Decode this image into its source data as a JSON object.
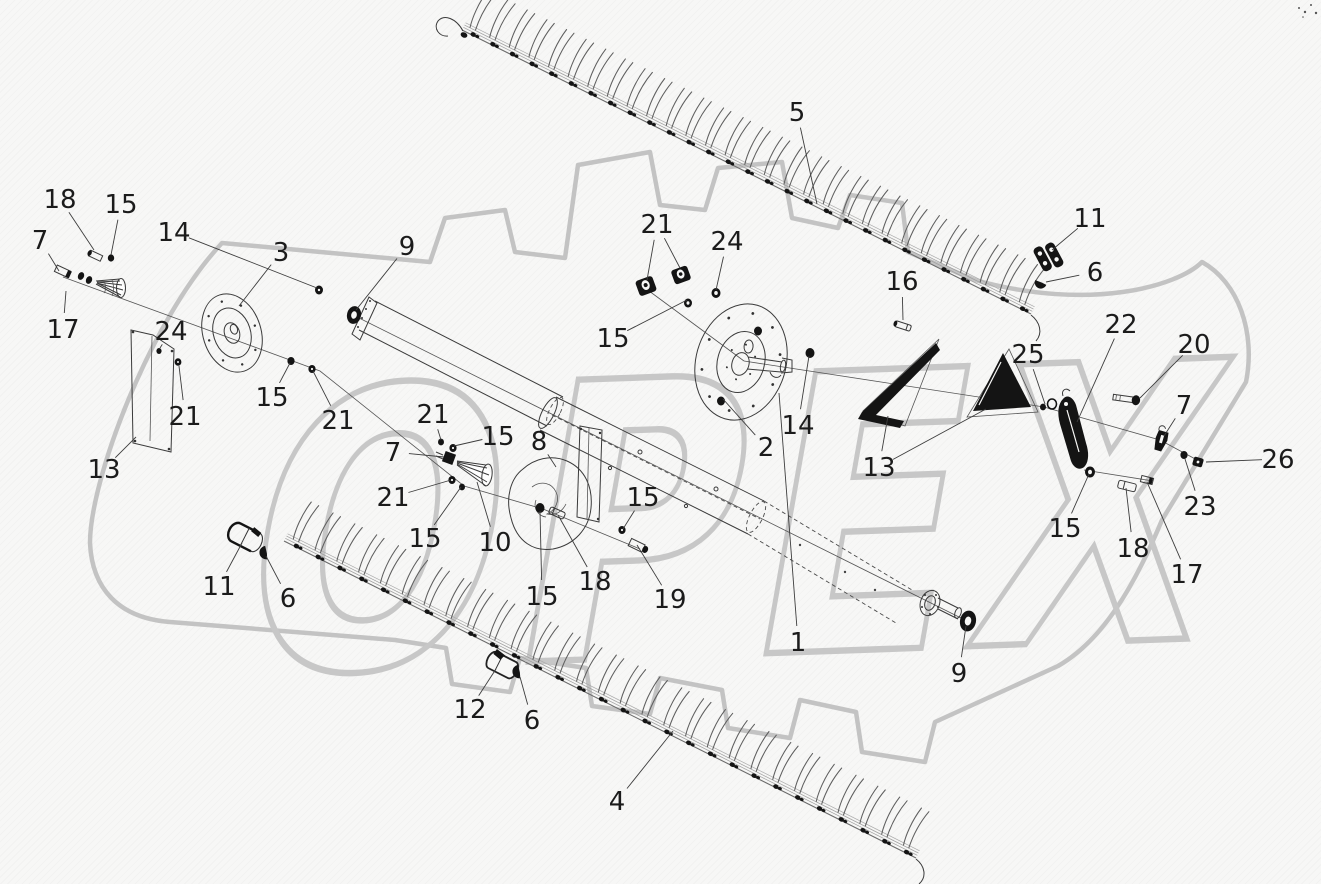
{
  "watermark": {
    "text": "OPEX",
    "color": "#c7c7c7"
  },
  "drawing": {
    "type": "exploded-parts-diagram",
    "background": "#f7f7f6",
    "line_color": "#3a3a3a",
    "part_fill_color": "#141414",
    "callout_color": "#1b1b1b"
  },
  "callouts": [
    {
      "label": "18",
      "x": 60,
      "y": 199,
      "targets": [
        [
          94,
          250
        ]
      ]
    },
    {
      "label": "15",
      "x": 121,
      "y": 204,
      "targets": [
        [
          111,
          255
        ]
      ]
    },
    {
      "label": "7",
      "x": 40,
      "y": 240,
      "targets": [
        [
          59,
          271
        ]
      ]
    },
    {
      "label": "17",
      "x": 63,
      "y": 329,
      "targets": [
        [
          66,
          291
        ]
      ]
    },
    {
      "label": "14",
      "x": 174,
      "y": 232,
      "targets": [
        [
          317,
          288
        ]
      ]
    },
    {
      "label": "3",
      "x": 281,
      "y": 252,
      "targets": [
        [
          239,
          306
        ]
      ]
    },
    {
      "label": "9",
      "x": 407,
      "y": 246,
      "targets": [
        [
          356,
          310
        ]
      ]
    },
    {
      "label": "24",
      "x": 171,
      "y": 331,
      "targets": [
        [
          160,
          348
        ]
      ]
    },
    {
      "label": "21",
      "x": 185,
      "y": 416,
      "targets": [
        [
          179,
          366
        ]
      ]
    },
    {
      "label": "13",
      "x": 104,
      "y": 469,
      "targets": [
        [
          136,
          437
        ]
      ]
    },
    {
      "label": "15",
      "x": 272,
      "y": 397,
      "targets": [
        [
          290,
          363
        ]
      ]
    },
    {
      "label": "21",
      "x": 338,
      "y": 420,
      "targets": [
        [
          313,
          371
        ]
      ]
    },
    {
      "label": "21",
      "x": 657,
      "y": 224,
      "targets": [
        [
          647,
          280
        ],
        [
          680,
          268
        ]
      ]
    },
    {
      "label": "24",
      "x": 727,
      "y": 241,
      "targets": [
        [
          716,
          290
        ]
      ]
    },
    {
      "label": "5",
      "x": 797,
      "y": 112,
      "targets": [
        [
          817,
          204
        ]
      ]
    },
    {
      "label": "15",
      "x": 613,
      "y": 338,
      "targets": [
        [
          687,
          300
        ]
      ]
    },
    {
      "label": "11",
      "x": 1090,
      "y": 218,
      "targets": [
        [
          1052,
          250
        ]
      ]
    },
    {
      "label": "6",
      "x": 1095,
      "y": 272,
      "targets": [
        [
          1046,
          282
        ]
      ]
    },
    {
      "label": "16",
      "x": 902,
      "y": 281,
      "targets": [
        [
          903,
          320
        ]
      ]
    },
    {
      "label": "22",
      "x": 1121,
      "y": 324,
      "targets": [
        [
          1077,
          422
        ]
      ]
    },
    {
      "label": "25",
      "x": 1028,
      "y": 354,
      "targets": [
        [
          1045,
          404
        ]
      ]
    },
    {
      "label": "20",
      "x": 1194,
      "y": 344,
      "targets": [
        [
          1140,
          398
        ]
      ]
    },
    {
      "label": "7",
      "x": 1184,
      "y": 405,
      "targets": [
        [
          1164,
          436
        ]
      ]
    },
    {
      "label": "26",
      "x": 1278,
      "y": 459,
      "targets": [
        [
          1206,
          462
        ]
      ]
    },
    {
      "label": "23",
      "x": 1200,
      "y": 506,
      "targets": [
        [
          1185,
          459
        ]
      ]
    },
    {
      "label": "2",
      "x": 766,
      "y": 447,
      "targets": [
        [
          723,
          399
        ]
      ]
    },
    {
      "label": "14",
      "x": 798,
      "y": 425,
      "targets": [
        [
          809,
          356
        ]
      ]
    },
    {
      "label": "13",
      "x": 879,
      "y": 467,
      "targets": [
        [
          888,
          416
        ],
        [
          986,
          409
        ]
      ]
    },
    {
      "label": "21",
      "x": 433,
      "y": 414,
      "targets": [
        [
          441,
          440
        ]
      ]
    },
    {
      "label": "15",
      "x": 498,
      "y": 436,
      "targets": [
        [
          454,
          446
        ]
      ]
    },
    {
      "label": "8",
      "x": 539,
      "y": 441,
      "targets": [
        [
          556,
          467
        ]
      ]
    },
    {
      "label": "7",
      "x": 393,
      "y": 452,
      "targets": [
        [
          444,
          457
        ]
      ]
    },
    {
      "label": "21",
      "x": 393,
      "y": 497,
      "targets": [
        [
          451,
          480
        ]
      ]
    },
    {
      "label": "15",
      "x": 425,
      "y": 538,
      "targets": [
        [
          461,
          487
        ]
      ]
    },
    {
      "label": "10",
      "x": 495,
      "y": 542,
      "targets": [
        [
          477,
          482
        ]
      ]
    },
    {
      "label": "15",
      "x": 643,
      "y": 497,
      "targets": [
        [
          623,
          529
        ]
      ]
    },
    {
      "label": "18",
      "x": 595,
      "y": 581,
      "targets": [
        [
          558,
          515
        ]
      ]
    },
    {
      "label": "15",
      "x": 542,
      "y": 596,
      "targets": [
        [
          540,
          511
        ]
      ]
    },
    {
      "label": "19",
      "x": 670,
      "y": 599,
      "targets": [
        [
          637,
          545
        ]
      ]
    },
    {
      "label": "15",
      "x": 1065,
      "y": 528,
      "targets": [
        [
          1089,
          474
        ]
      ]
    },
    {
      "label": "18",
      "x": 1133,
      "y": 548,
      "targets": [
        [
          1126,
          488
        ]
      ]
    },
    {
      "label": "17",
      "x": 1187,
      "y": 574,
      "targets": [
        [
          1147,
          482
        ]
      ]
    },
    {
      "label": "11",
      "x": 219,
      "y": 586,
      "targets": [
        [
          242,
          543
        ]
      ]
    },
    {
      "label": "6",
      "x": 288,
      "y": 598,
      "targets": [
        [
          266,
          556
        ]
      ]
    },
    {
      "label": "12",
      "x": 470,
      "y": 709,
      "targets": [
        [
          496,
          669
        ]
      ]
    },
    {
      "label": "6",
      "x": 532,
      "y": 720,
      "targets": [
        [
          520,
          677
        ]
      ]
    },
    {
      "label": "1",
      "x": 798,
      "y": 642,
      "targets": [
        [
          779,
          393
        ]
      ]
    },
    {
      "label": "9",
      "x": 959,
      "y": 673,
      "targets": [
        [
          966,
          626
        ]
      ]
    },
    {
      "label": "4",
      "x": 617,
      "y": 801,
      "targets": [
        [
          673,
          731
        ]
      ]
    }
  ]
}
